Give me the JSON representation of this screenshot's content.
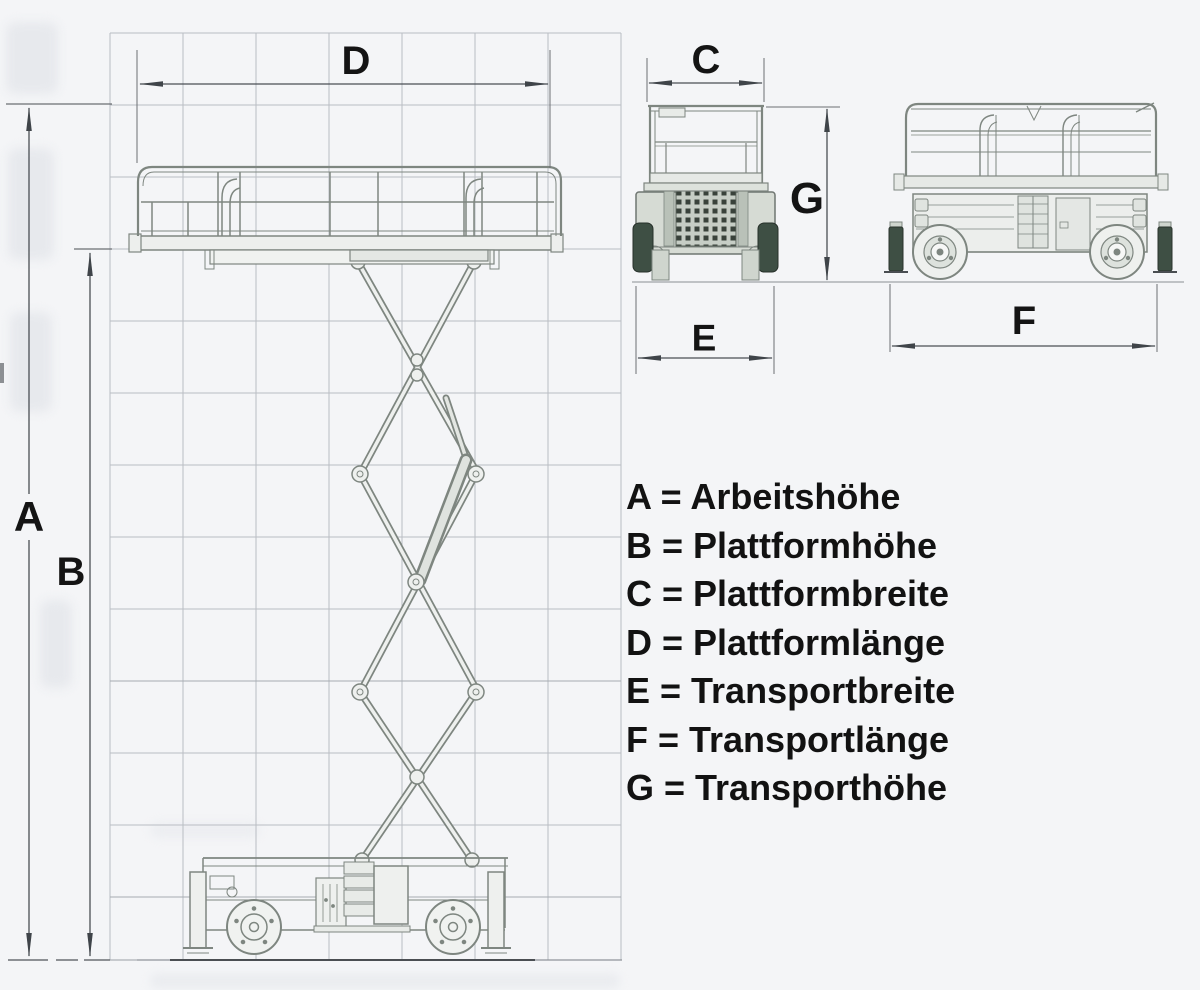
{
  "colors": {
    "background": "#f4f5f7",
    "grid_line": "#b9bdc3",
    "drawing_line": "#7e8680",
    "drawing_fill": "#eef0ee",
    "chassis_fill": "#d6dbd4",
    "dimension_line": "#4a4f54",
    "arrowhead": "#3f4449",
    "label_text": "#141414",
    "tire_fill": "#3e4f44",
    "ground_line": "#4a4e52"
  },
  "dimension_labels": {
    "A": "A",
    "B": "B",
    "C": "C",
    "D": "D",
    "E": "E",
    "F": "F",
    "G": "G"
  },
  "legend": {
    "items": [
      {
        "letter": "A",
        "term": "Arbeitshöhe",
        "text": "A = Arbeitshöhe"
      },
      {
        "letter": "B",
        "term": "Plattformhöhe",
        "text": "B = Plattformhöhe"
      },
      {
        "letter": "C",
        "term": "Plattformbreite",
        "text": "C = Plattformbreite"
      },
      {
        "letter": "D",
        "term": "Plattformlänge",
        "text": "D = Plattformlänge"
      },
      {
        "letter": "E",
        "term": "Transportbreite",
        "text": "E = Transportbreite"
      },
      {
        "letter": "F",
        "term": "Transportlänge",
        "text": "F = Transportlänge"
      },
      {
        "letter": "G",
        "term": "Transporthöhe",
        "text": "G = Transporthöhe"
      }
    ]
  }
}
